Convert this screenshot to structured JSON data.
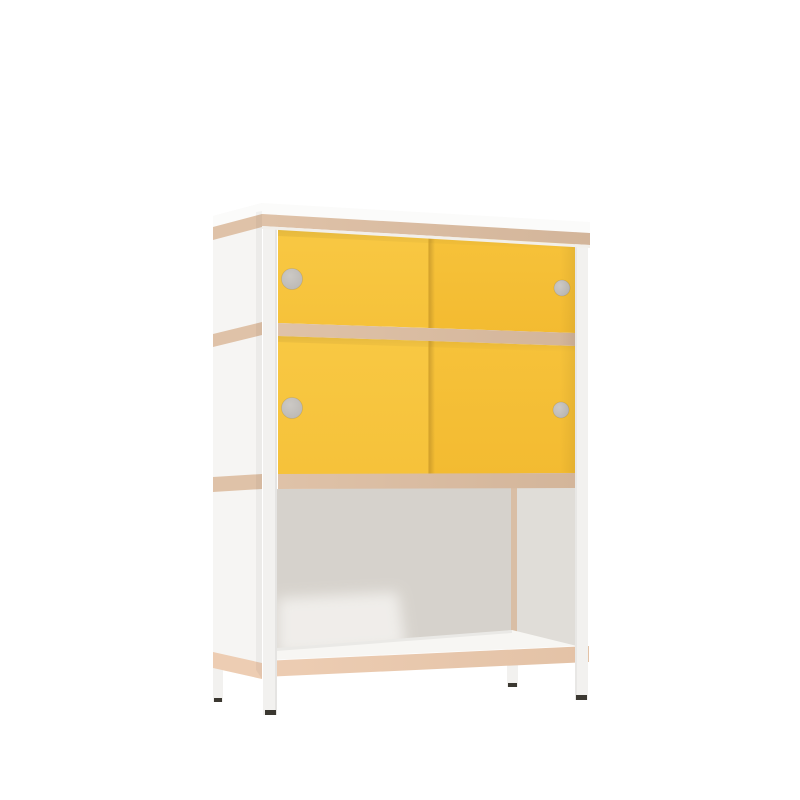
{
  "scene": {
    "description": "Product render of a sideboard cabinet with white steel frame legs, plywood-edged white panels, two rows of yellow sliding doors with round finger-hole handles, and an open bottom shelf, shown in slight two-point perspective on a white background",
    "object": "cabinet-with-sliding-doors",
    "door_count": 4,
    "handle_count": 4,
    "shelf_levels": 3,
    "open_compartments": 1
  },
  "colors": {
    "background": "#FFFFFF",
    "door_yellow_light": "#F8C843",
    "door_yellow": "#F6C23A",
    "door_yellow_deep": "#F3BB31",
    "door_seam": "#D7A52D",
    "plywood": "#DFC2A8",
    "plywood_dark": "#D3B59A",
    "plywood_bottom": "#EDCDB3",
    "plywood_bottom_dark": "#E3C2A6",
    "frame_white": "#F2F1EF",
    "panel_white": "#F6F5F3",
    "top_white": "#FBFBFA",
    "track_white": "#F2EFEA",
    "shelf_white": "#F7F6F3",
    "interior_back": "#D6D2CC",
    "interior_right": "#E0DDD8",
    "interior_corner": "#D9BEA5",
    "interior_highlight": "#F3F1EE",
    "handle_light": "#CCC9C5",
    "handle_dark": "#BBB8B4",
    "foot_dark": "#3B3831"
  }
}
